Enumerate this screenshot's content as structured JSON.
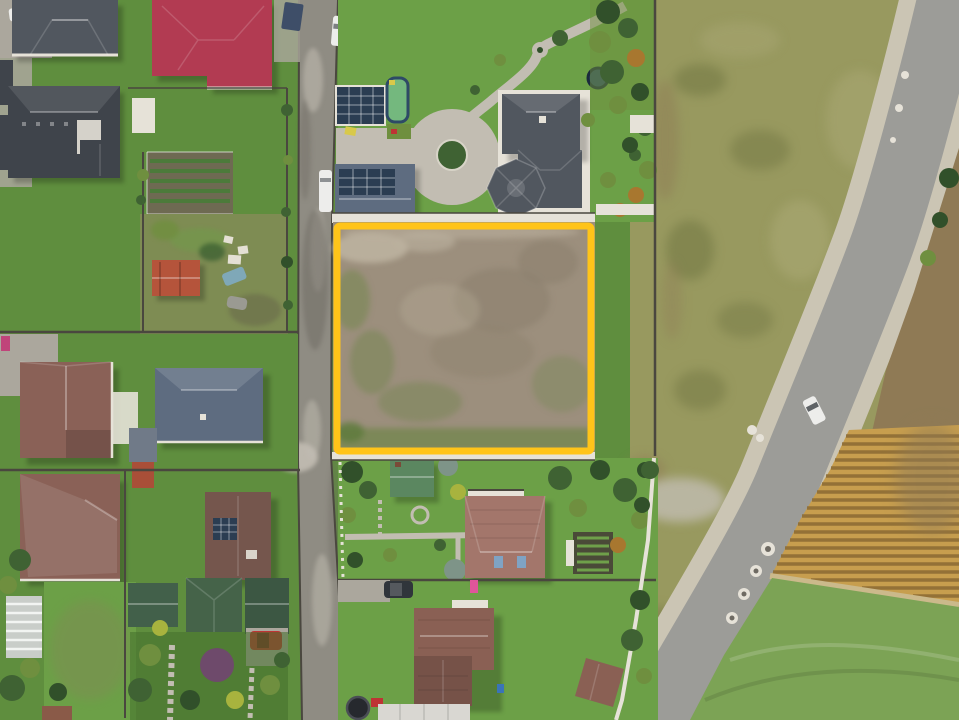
{
  "image": {
    "type": "aerial-drone-photograph",
    "subject": "Top-down drone view of a suburban neighborhood with a vacant land plot for sale highlighted by a yellow rectangular boundary",
    "annotation": {
      "shape": "rectangle",
      "purpose": "land-plot-boundary-highlight",
      "color": "#FFC419"
    }
  },
  "palette": {
    "accent": "#FFC419",
    "street": "#8F8C83",
    "street_dark": "#6E6A62",
    "street_edge": "#4A473F",
    "road_asphalt": "#9C9C98",
    "road_shoulder": "#CBC5B4",
    "lawn": "#5F8E3E",
    "lawn_bright": "#6CA047",
    "lawn_olive": "#7E8C53",
    "lawn_dark": "#43702C",
    "field_scrub": "#98995F",
    "field_blotch": "#6E7440",
    "field_green": "#7CA355",
    "field_light": "#B0AD7A",
    "corn": "#C79E4E",
    "corn_dark": "#8A6A33",
    "straw": "#CBB98B",
    "soil": "#8F7A55",
    "dirt": "#9C8F7D",
    "dirt_light": "#BDB2A0",
    "dirt_dark": "#8A7D6B",
    "dirt_green": "#74864F",
    "roof_red": "#B23B52",
    "roof_dark": "#51575F",
    "roof_darker": "#3F444B",
    "roof_slate": "#5E6C80",
    "roof_mauve": "#8A6157",
    "roof_brown": "#8A6054",
    "roof_salmon": "#A3766B",
    "roof_green": "#5B8760",
    "roof_forest": "#42604A",
    "roof_white": "#D9D7D2",
    "wall": "#E6E2D8",
    "pave": "#C2BDB2",
    "pave_dark": "#ABA79D",
    "solar": "#2B3D52",
    "pool": "#74B87E",
    "pool_rim": "#9FD3E6",
    "tree": "#3F6233",
    "tree_dark": "#31502A",
    "tree_light": "#6F8F3F",
    "tree_autumn": "#A8772F",
    "tree_purple": "#6E4A6B",
    "tree_blue": "#7E9488",
    "bush_yellow": "#A8B33E",
    "car_white": "#EDEDEB",
    "car_dark": "#30353B",
    "car_red": "#BE3434",
    "car_blue": "#7FA8B8",
    "tarp": "#3E4E68",
    "trampoline": "#2E4A66",
    "skylight": "#7FA3C4",
    "slide_pink": "#E0559A",
    "item_blue": "#3A74B8"
  },
  "scene": {
    "landmarks": [
      {
        "name": "land-plot",
        "description": "vacant dirt plot with sparse green patches, outlined in yellow"
      },
      {
        "name": "gravel-street",
        "description": "unpaved residential street running vertically along the plot's west side"
      },
      {
        "name": "country-road",
        "description": "asphalt road curving diagonally along the right side"
      },
      {
        "name": "right-field",
        "description": "large scrubby khaki field east of the plot"
      },
      {
        "name": "corn-field",
        "description": "harvested golden corn rows, lower right"
      },
      {
        "name": "mown-field",
        "description": "bright green mowed field, bottom right corner"
      },
      {
        "name": "estate-north",
        "description": "large gray-roofed villa with circular driveway, winding garden path, pool, solar roofs and trampoline"
      },
      {
        "name": "house-red-roof",
        "description": "crimson hipped roof house, top left"
      },
      {
        "name": "houses-west",
        "description": "gray and mauve roofed houses with lawns, west block"
      },
      {
        "name": "houses-south",
        "description": "brown roofed houses, gardens, green sheds and greenhouse, south block"
      }
    ],
    "vehicles": [
      {
        "name": "road-car",
        "description": "white car driving on the diagonal road"
      },
      {
        "name": "street-car-top",
        "description": "white car parked on street, top"
      },
      {
        "name": "street-van",
        "description": "white van parked on street, middle"
      },
      {
        "name": "red-car",
        "description": "red car parked in southern driveway"
      },
      {
        "name": "dark-car",
        "description": "dark car parked by southern house"
      }
    ]
  }
}
